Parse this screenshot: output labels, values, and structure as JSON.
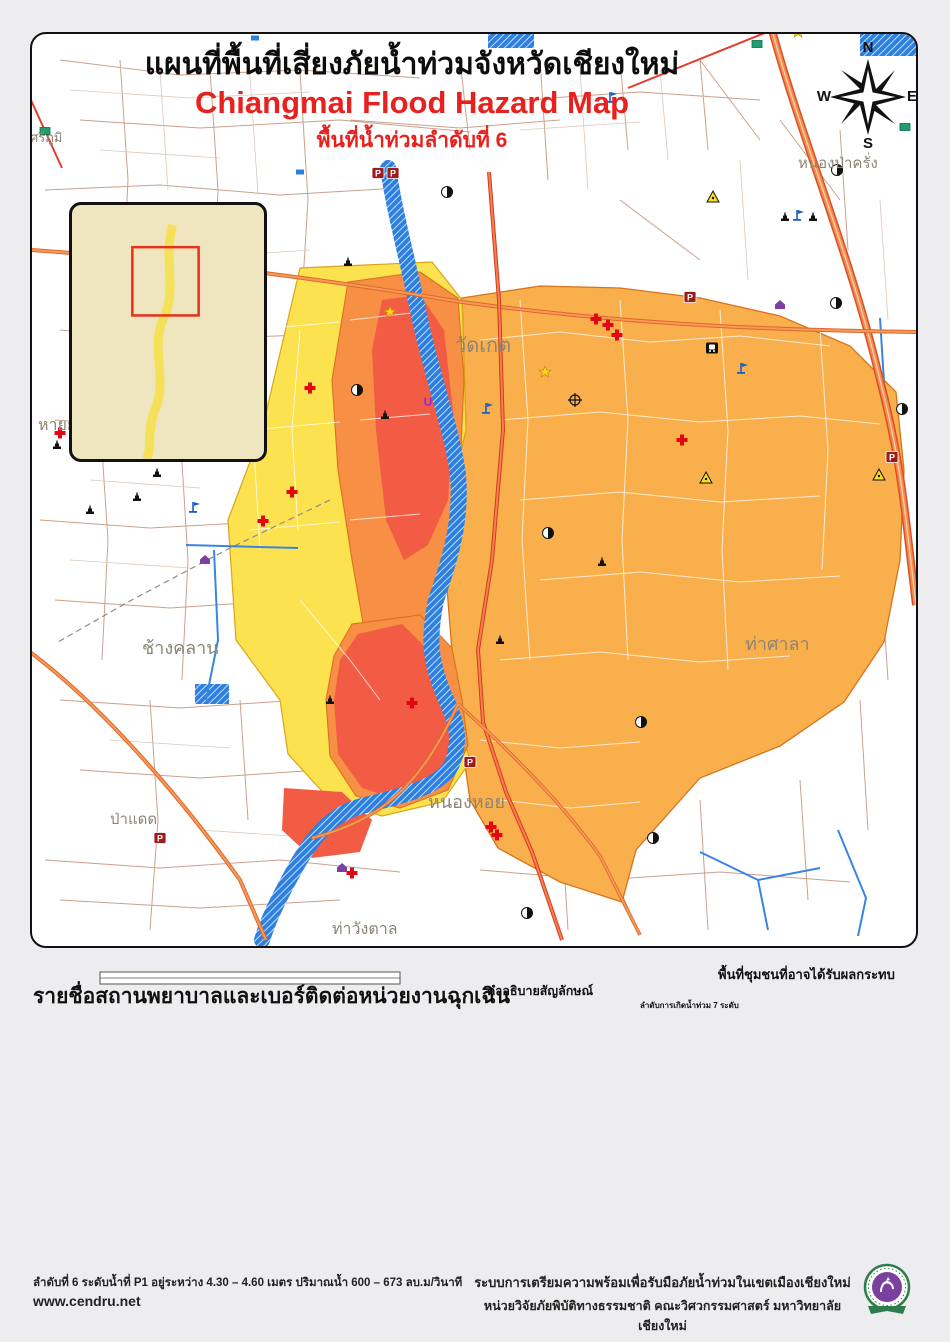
{
  "title": {
    "line1": "แผนที่พื้นที่เสี่ยงภัยน้ำท่วมจังหวัดเชียงใหม่",
    "line2": "Chiangmai Flood Hazard Map",
    "line3": "พื้นที่น้ำท่วมลำดับที่ 6"
  },
  "compass": {
    "n": "N",
    "e": "E",
    "s": "S",
    "w": "W"
  },
  "scalebar": {
    "label": "กิโลเมตร",
    "ticks": [
      {
        "t": "0",
        "p": 0
      },
      {
        "t": ".2",
        "p": 0.125
      },
      {
        "t": ".4",
        "p": 0.25
      },
      {
        "t": ".8",
        "p": 0.5
      },
      {
        "t": "1.2",
        "p": 0.75
      },
      {
        "t": "1.6",
        "p": 1
      }
    ]
  },
  "hospital_section": {
    "header": "รายชื่อสถานพยาบาลและเบอร์ติดต่อหน่วยงานฉุกเฉิน",
    "hospitals": [
      {
        "name": "โรงพยาบาลแมคคอมิค",
        "phone": "053-241311"
      },
      {
        "name": "โรงพยาบาลจินดาสิงห์เนตร",
        "phone": "053-244140"
      },
      {
        "name": "โรงพยาบาลเทศบาล",
        "phone": "053-2332114-9"
      },
      {
        "name": "โรงพยาบาลค่ายกาวิละ(ในค่าย)",
        "phone": "053-241644"
      },
      {
        "name": "โรงพยาบาลเซ็นทรัลเมมโมเรียล",
        "phone": "053-277090-3"
      },
      {
        "name": "โรงพยาบาลรวมแพทย์",
        "phone": "053-270144-50"
      },
      {
        "name": "โรงพยาบาลมหาราชนครเชียงใหม่",
        "phone": "053-945602-3"
      },
      {
        "name": "โรงพยาบาลเชียงใหม่-ราม1",
        "phone": "053-894260"
      },
      {
        "name": "โรงพยาบาลช้างเผือก",
        "phone": "053-220022-31"
      },
      {
        "name": "โรงพยาบาลเชียงใหม่-ราม2",
        "phone": "053-852999"
      },
      {
        "name": "โรงพยาบาลลานนา",
        "phone": "053-211037-41"
      },
      {
        "name": "โรงพยาบาลใกล้หมอ",
        "phone": "053-200002"
      },
      {
        "name": "โรงพยาบาลราชเวช",
        "phone": "053-801199-201"
      },
      {
        "name": "โรงพยาบาลหมอวงค์",
        "phone": "053-211697"
      },
      {
        "name": "โรงพยาบาลนครพิงค์จังหวัดเชียงใหม่",
        "phone": "053-222152"
      }
    ],
    "agencies": [
      {
        "name": "ฉุกเฉิน ตำรวจ รถดับเพลิง และรถพยาบาล",
        "phone": "191"
      },
      {
        "name": "กู้ภัย ดับเพลิง",
        "phone": "199"
      },
      {
        "name": "กู้ชีพ ผู้ป่วยฉุกเฉิน",
        "phone": "1669"
      },
      {
        "name": "เทศบาลนครเชียงใหม่",
        "phone": "053-234414, 053-259121"
      },
      {
        "name": "การไฟฟ้าเขต 1",
        "phone": "053-241018"
      },
      {
        "name": "สำนักชลประทานที่ 1",
        "phone": "053-242822"
      },
      {
        "name": "ศูนย์อุตุนิยมวิทยาภาคเหนือ",
        "phone": "053-277919"
      },
      {
        "name": "สำนักงานป้องกันและบรรเทาสาธารณภัยจังหวัดเชียงใหม่",
        "phone": "053-221470"
      },
      {
        "name": "สำนักงานประปาจังหวัดเชียงใหม่",
        "phone": "053-233479"
      },
      {
        "name": "ตำรวจภูธรจังหวัดเชียงใหม่",
        "phone": "053-240283"
      },
      {
        "name": "สำนักงานสาธารณสุขจังหวัดเชียงใหม่",
        "phone": "053-211048-50"
      },
      {
        "name": "สำนักงานโยธาธิการและผังเมืองจังหวัดเชียงใหม่",
        "phone": "053-112727"
      },
      {
        "name": "สำนักงานขนส่งจังหวัดเชียงใหม่",
        "phone": "1584 , 053-270409"
      },
      {
        "name": "สถานีวิทยุ FM 93.25 MHz สำนักประชาสัมพันธ์ เขต 3",
        "phone": "053-821193"
      },
      {
        "name": "สถานีวิทยุ FM 100 MHz มหาวิทยาลัยเชียงใหม่",
        "phone": "053-213510"
      },
      {
        "name": "ศูนย์อาสาสมัครป้องกันภัยฝ่ายพลเรือนเทศบาลนครเชียงใหม่",
        "phone": "053-904969"
      },
      {
        "name": "หน่วยวิจัยภัยพิบัติทางธรรมชาติ มหาวิทยาลัยเชียงใหม่",
        "phone": "053-942010"
      }
    ]
  },
  "legend": {
    "header": "คำอธิบายสัญลักษณ์",
    "points": [
      {
        "icon": "gas",
        "label": "ปั๊มน้ำมัน"
      },
      {
        "icon": "triangle",
        "label": "หน่วยงานด้านสาธารณูปการ"
      },
      {
        "icon": "cross",
        "label": "โรงพยาบาล"
      },
      {
        "icon": "military",
        "label": "ค่าย/ราชการด้านทหาร"
      },
      {
        "icon": "police",
        "label": "ป้อม/สถานีตำรวจ"
      },
      {
        "icon": "train",
        "label": "สถานีรถไฟ"
      },
      {
        "icon": "temple",
        "label": "วัด"
      },
      {
        "icon": "flag",
        "label": "โรงเรียน"
      },
      {
        "icon": "uni",
        "label": "วิทยาลัย,มหาวิทยาลัย,สถาบัน"
      },
      {
        "icon": "house",
        "label": "บ้าน/หมู่บ้าน"
      },
      {
        "icon": "star",
        "label": "ศูนย์การค้า"
      }
    ],
    "lines": [
      {
        "type": "hw-national",
        "label": "ทางหลวงแผ่นดิน"
      },
      {
        "type": "hw-provincial",
        "label": "ทางหลวงจังหวัด"
      },
      {
        "type": "road",
        "label": "ถนน"
      },
      {
        "type": "soi",
        "label": "ซอย"
      },
      {
        "type": "boundary",
        "label": "ขอบเขตตำบล"
      },
      {
        "type": "water",
        "label": "แหล่งน้ำ"
      }
    ],
    "flood": {
      "header": "ลำดับการเกิดน้ำท่วม 7 ระดับ",
      "levels": [
        {
          "n": "1",
          "color": "#F44F3B"
        },
        {
          "n": "2",
          "color": "#F97A40"
        },
        {
          "n": "3",
          "color": "#FA9340"
        },
        {
          "n": "4",
          "color": "#FAA744"
        },
        {
          "n": "5",
          "color": "#FBB447"
        },
        {
          "n": "6",
          "color": "#FDD64B"
        },
        {
          "n": "7",
          "color": "#FDF951"
        }
      ]
    }
  },
  "impact": {
    "header": "พื้นที่ชุมชนที่อาจได้รับผลกระทบ",
    "lines": [
      "บ้านป่าพร้าวนอก(บางส่วน), โรงเหล้า,",
      "ร้านอาหารวังปลา, ร้านอาหารท่าน้ำ,",
      "ทางลอดใต้สะพานไปป่าแดด บ้านเด่น",
      "การไฟฟ้าบ้านเด่น, หมู่บ้านจินดานิเวศน์",
      "ถนนเจริญประเทศ, โรงเรียนมงฟอร์ต",
      "ประถม, ป่าไม้เชียงใหม่, วัดชัยมงคล, บ้านป่าพร้าวนอก,",
      "หมู่บ้านเวียงทอง, ตำบลป่าแดด (บางส่วน)",
      "ห้างริมปิงซุปเปอร์สโตร์, วัดท่าสะต้อย,",
      "ตลาดทองคำ, ค่ายกาวิละ, ถนนกองทราย,",
      "ตลาดสันป่าข่อย (บางส่วน) ตลาดหนองหอย,",
      "ถนนเกาะกลาง, โรงเรียนมงฟอร์ต, โรงเรียนกาวิละ,",
      "วัดเมืองสาตร,หมู่บ้านปาล์มสปริง, วัดเมืองกาย,",
      "สนามกอล์ฟ,ถนนราษฎร์อุทิศ ถนนประชาสัมพันธ์,",
      "ถนนช้างคลาน,ไนท์บาซาร์,แยกแสงตะวัน,",
      "ถนนลอยเคราะห์(บางส่วน)",
      ",วัดหัวฝาย,ม.เชียงใหม่แลนด์"
    ]
  },
  "footer": {
    "left1": "ลำดับที่ 6 ระดับน้ำที่ P1 อยู่ระหว่าง 4.30 – 4.60 เมตร ปริมาณน้ำ 600 – 673 ลบ.ม/วินาที",
    "left2": "www.cendru.net",
    "right1": "ระบบการเตรียมความพร้อมเพื่อรับมือภัยน้ำท่วมในเขตเมืองเชียงใหม่",
    "right2": "หน่วยวิจัยภัยพิบัติทางธรรมชาติ คณะวิศวกรรมศาสตร์ มหาวิทยาลัยเชียงใหม่"
  },
  "map": {
    "labels": [
      {
        "t": "วัดเกต",
        "x": 455,
        "y": 352,
        "s": 20
      },
      {
        "t": "หนองป่าครั่ง",
        "x": 798,
        "y": 168,
        "s": 15
      },
      {
        "t": "ช้างคลาน",
        "x": 142,
        "y": 654,
        "s": 18
      },
      {
        "t": "ท่าศาลา",
        "x": 745,
        "y": 650,
        "s": 18
      },
      {
        "t": "หนองหอย",
        "x": 428,
        "y": 808,
        "s": 18
      },
      {
        "t": "ป่าแดด",
        "x": 110,
        "y": 824,
        "s": 15
      },
      {
        "t": "ท่าวังตาล",
        "x": 332,
        "y": 934,
        "s": 16
      },
      {
        "t": "หายยา",
        "x": 38,
        "y": 430,
        "s": 16
      },
      {
        "t": "ศรีภูมิ",
        "x": 30,
        "y": 142,
        "s": 13
      }
    ],
    "icons": [
      {
        "t": "police",
        "x": 378,
        "y": 173
      },
      {
        "t": "police",
        "x": 393,
        "y": 173
      },
      {
        "t": "police",
        "x": 160,
        "y": 838
      },
      {
        "t": "police",
        "x": 690,
        "y": 297
      },
      {
        "t": "police",
        "x": 892,
        "y": 457
      },
      {
        "t": "police",
        "x": 470,
        "y": 762
      },
      {
        "t": "cross",
        "x": 60,
        "y": 433
      },
      {
        "t": "cross",
        "x": 136,
        "y": 386
      },
      {
        "t": "cross",
        "x": 310,
        "y": 388
      },
      {
        "t": "cross",
        "x": 263,
        "y": 521
      },
      {
        "t": "cross",
        "x": 292,
        "y": 492
      },
      {
        "t": "cross",
        "x": 596,
        "y": 319
      },
      {
        "t": "cross",
        "x": 608,
        "y": 325
      },
      {
        "t": "cross",
        "x": 617,
        "y": 335
      },
      {
        "t": "cross",
        "x": 682,
        "y": 440
      },
      {
        "t": "cross",
        "x": 412,
        "y": 703
      },
      {
        "t": "cross",
        "x": 491,
        "y": 827
      },
      {
        "t": "cross",
        "x": 497,
        "y": 835
      },
      {
        "t": "cross",
        "x": 352,
        "y": 873
      },
      {
        "t": "gas",
        "x": 447,
        "y": 192
      },
      {
        "t": "gas",
        "x": 357,
        "y": 390
      },
      {
        "t": "gas",
        "x": 548,
        "y": 533
      },
      {
        "t": "gas",
        "x": 641,
        "y": 722
      },
      {
        "t": "gas",
        "x": 653,
        "y": 838
      },
      {
        "t": "gas",
        "x": 527,
        "y": 913
      },
      {
        "t": "gas",
        "x": 837,
        "y": 170
      },
      {
        "t": "gas",
        "x": 902,
        "y": 409
      },
      {
        "t": "gas",
        "x": 836,
        "y": 303
      },
      {
        "t": "temple",
        "x": 57,
        "y": 445
      },
      {
        "t": "temple",
        "x": 135,
        "y": 457
      },
      {
        "t": "temple",
        "x": 157,
        "y": 473
      },
      {
        "t": "temple",
        "x": 137,
        "y": 497
      },
      {
        "t": "temple",
        "x": 90,
        "y": 510
      },
      {
        "t": "temple",
        "x": 348,
        "y": 262
      },
      {
        "t": "temple",
        "x": 785,
        "y": 217
      },
      {
        "t": "temple",
        "x": 813,
        "y": 217
      },
      {
        "t": "temple",
        "x": 385,
        "y": 415
      },
      {
        "t": "temple",
        "x": 500,
        "y": 640
      },
      {
        "t": "temple",
        "x": 330,
        "y": 700
      },
      {
        "t": "temple",
        "x": 602,
        "y": 562
      },
      {
        "t": "flag",
        "x": 193,
        "y": 507
      },
      {
        "t": "flag",
        "x": 797,
        "y": 215
      },
      {
        "t": "flag",
        "x": 486,
        "y": 408
      },
      {
        "t": "flag",
        "x": 741,
        "y": 368
      },
      {
        "t": "flag",
        "x": 610,
        "y": 97
      },
      {
        "t": "train",
        "x": 712,
        "y": 348
      },
      {
        "t": "triangle",
        "x": 713,
        "y": 197
      },
      {
        "t": "triangle",
        "x": 879,
        "y": 475
      },
      {
        "t": "triangle",
        "x": 706,
        "y": 478
      },
      {
        "t": "house",
        "x": 342,
        "y": 868
      },
      {
        "t": "house",
        "x": 780,
        "y": 305
      },
      {
        "t": "house",
        "x": 205,
        "y": 560
      },
      {
        "t": "uni",
        "x": 428,
        "y": 402
      },
      {
        "t": "star",
        "x": 390,
        "y": 312
      },
      {
        "t": "star",
        "x": 545,
        "y": 372
      },
      {
        "t": "star",
        "x": 798,
        "y": 32
      },
      {
        "t": "military",
        "x": 575,
        "y": 400
      },
      {
        "t": "greenbox",
        "x": 757,
        "y": 44
      },
      {
        "t": "greenbox",
        "x": 905,
        "y": 127
      },
      {
        "t": "greenbox",
        "x": 45,
        "y": 131
      },
      {
        "t": "bluebox",
        "x": 255,
        "y": 38
      },
      {
        "t": "bluebox",
        "x": 300,
        "y": 172
      }
    ]
  },
  "inset": {
    "tiles": [
      {
        "l": "ช้างเผือก",
        "x": 2,
        "y": 2,
        "w": 66,
        "h": 44,
        "c": "#DD6A55"
      },
      {
        "l": "สันผีเสื้อ",
        "x": 70,
        "y": 2,
        "w": 42,
        "h": 13,
        "c": "#F0994F"
      },
      {
        "l": "ฟ้าฮ่าม",
        "x": 70,
        "y": 15,
        "w": 40,
        "h": 13,
        "c": "#F5B963"
      },
      {
        "l": "ป่าตัน",
        "x": 70,
        "y": 28,
        "w": 36,
        "h": 13,
        "c": "#F0994F"
      },
      {
        "l": "สันทรายน้อย",
        "x": 112,
        "y": 2,
        "w": 79,
        "h": 26,
        "c": "#C2D98E"
      },
      {
        "l": "สันพระเนตร",
        "x": 112,
        "y": 20,
        "w": 54,
        "h": 18,
        "c": "#E4ECC0"
      },
      {
        "l": "สันปูเลย",
        "x": 166,
        "y": 20,
        "w": 25,
        "h": 24,
        "c": "#DCE59A"
      },
      {
        "l": "สุเทพ",
        "x": 2,
        "y": 46,
        "w": 38,
        "h": 70,
        "c": "#E4ECC0"
      },
      {
        "l": "ศรีภูมิ",
        "x": 40,
        "y": 40,
        "w": 32,
        "h": 22,
        "c": "#F0994F"
      },
      {
        "l": "วัดเกต",
        "x": 72,
        "y": 42,
        "w": 32,
        "h": 26,
        "c": "#F5E04E"
      },
      {
        "l": "หนองป่าครั่ง",
        "x": 104,
        "y": 44,
        "w": 48,
        "h": 22,
        "c": "#F5B963"
      },
      {
        "l": "สันกลาง",
        "x": 140,
        "y": 62,
        "w": 51,
        "h": 40,
        "c": "#E4ECC0"
      },
      {
        "l": "พระสิงห์",
        "x": 40,
        "y": 62,
        "w": 34,
        "h": 20,
        "c": "#F0994F"
      },
      {
        "l": "หายยา",
        "x": 44,
        "y": 82,
        "w": 30,
        "h": 20,
        "c": "#F5B963"
      },
      {
        "l": "ช้างคลาน",
        "x": 58,
        "y": 82,
        "w": 42,
        "h": 22,
        "c": "#DD6A55"
      },
      {
        "l": "ท่าศาลา",
        "x": 102,
        "y": 76,
        "w": 52,
        "h": 30,
        "c": "#F0994F"
      },
      {
        "l": "หนองหอย",
        "x": 74,
        "y": 96,
        "w": 48,
        "h": 24,
        "c": "#F5E04E"
      },
      {
        "l": "ไชยสถาน",
        "x": 126,
        "y": 102,
        "w": 44,
        "h": 38,
        "c": "#6FA8D4"
      },
      {
        "l": "ต้นเปา",
        "x": 162,
        "y": 100,
        "w": 29,
        "h": 34,
        "c": "#E4ECC0"
      },
      {
        "l": "แม่เหียะ",
        "x": 2,
        "y": 116,
        "w": 42,
        "h": 34,
        "c": "#6FA8D4"
      },
      {
        "l": "หนองควาย",
        "x": 2,
        "y": 145,
        "w": 44,
        "h": 24,
        "c": "#9FC3DC"
      },
      {
        "l": "สันผักหวาน",
        "x": 2,
        "y": 168,
        "w": 54,
        "h": 22,
        "c": "#C2D98E"
      },
      {
        "l": "ท่าวังตาล",
        "x": 52,
        "y": 138,
        "w": 48,
        "h": 40,
        "c": "#F5B963"
      },
      {
        "l": "หนองผึ้ง",
        "x": 92,
        "y": 134,
        "w": 44,
        "h": 34,
        "c": "#F5E04E"
      },
      {
        "l": "บ้านบง",
        "x": 146,
        "y": 132,
        "w": 45,
        "h": 20,
        "c": "#E8D5A0"
      },
      {
        "l": "สันกำแพง",
        "x": 150,
        "y": 152,
        "w": 41,
        "h": 24,
        "c": "#F0B98F"
      },
      {
        "l": "ชมภู",
        "x": 152,
        "y": 166,
        "w": 39,
        "h": 40,
        "c": "#DD6A55"
      },
      {
        "l": "ยางเนิ้ง",
        "x": 116,
        "y": 176,
        "w": 40,
        "h": 26,
        "c": "#DCE59A"
      },
      {
        "l": "สบแม่ข่า",
        "x": 52,
        "y": 190,
        "w": 44,
        "h": 22,
        "c": "#F0994F"
      },
      {
        "l": "ดอนแก้ว",
        "x": 88,
        "y": 188,
        "w": 34,
        "h": 24,
        "c": "#DD6A55"
      },
      {
        "l": "บ้านแหวน",
        "x": 2,
        "y": 196,
        "w": 52,
        "h": 24,
        "c": "#C2D98E"
      },
      {
        "l": "หนองแฝก",
        "x": 106,
        "y": 200,
        "w": 46,
        "h": 24,
        "c": "#C2D98E"
      },
      {
        "l": "สารภี",
        "x": 150,
        "y": 206,
        "w": 40,
        "h": 30,
        "c": "#E4ECC0"
      },
      {
        "l": "ขุนคง",
        "x": 20,
        "y": 222,
        "w": 44,
        "h": 26,
        "c": "#DD6A55"
      },
      {
        "l": "ชัวมุง",
        "x": 58,
        "y": 224,
        "w": 42,
        "h": 26,
        "c": "#DD6A55"
      },
      {
        "l": "ท่ากว้าง",
        "x": 90,
        "y": 240,
        "w": 44,
        "h": 13,
        "c": "#F0994F"
      }
    ]
  }
}
